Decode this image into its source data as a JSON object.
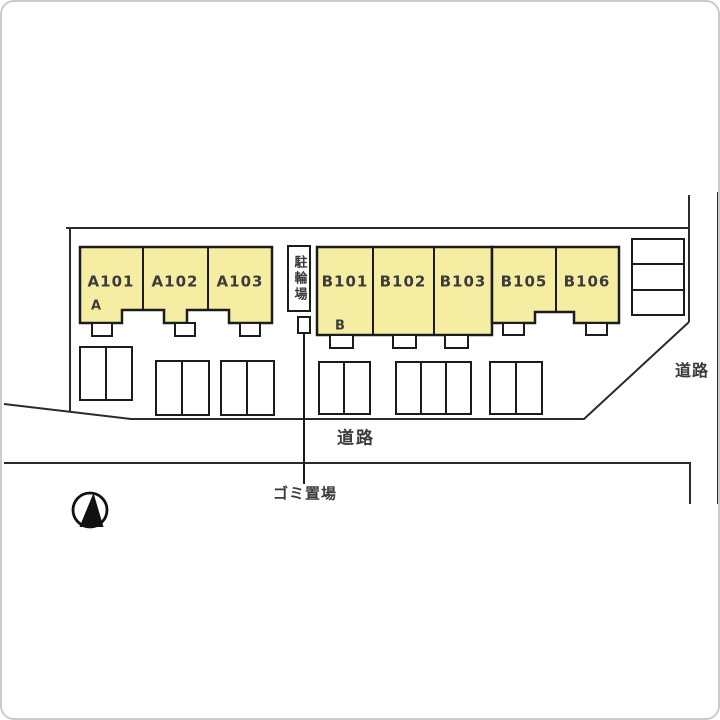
{
  "buildings": {
    "a": {
      "mark": "A",
      "units": [
        "A101",
        "A102",
        "A103"
      ]
    },
    "b": {
      "mark": "B",
      "units": [
        "B101",
        "B102",
        "B103",
        "B105",
        "B106"
      ]
    }
  },
  "facilities": {
    "bicycle_parking": "駐輪場",
    "garbage_area": "ゴミ置場"
  },
  "roads": {
    "bottom": "道路",
    "right": "道路"
  },
  "icons": {
    "compass": "north-arrow-icon"
  },
  "colors": {
    "unit_fill": "#f5eda1",
    "line": "#2b2b2b",
    "text": "#3b3b3b"
  }
}
